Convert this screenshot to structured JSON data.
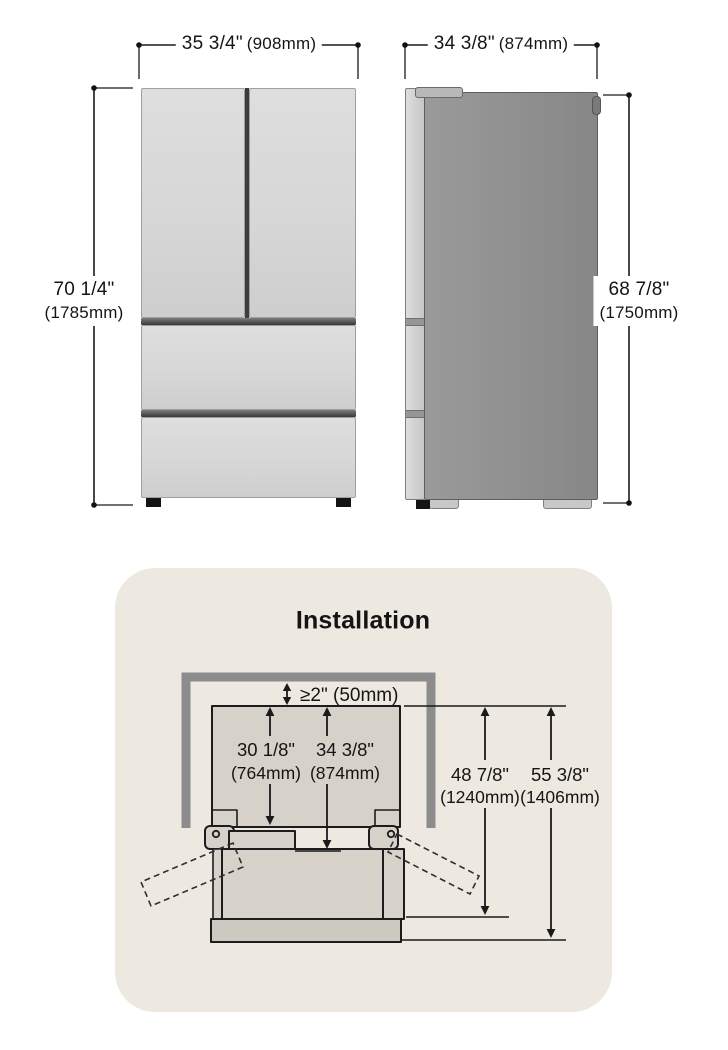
{
  "front_view": {
    "name": "refrigerator front view",
    "width": {
      "inches": "35 3/4\"",
      "mm": "(908mm)"
    },
    "height": {
      "inches": "70 1/4\"",
      "mm": "(1785mm)"
    }
  },
  "side_view": {
    "name": "refrigerator side view",
    "depth": {
      "inches": "34 3/8\"",
      "mm": "(874mm)"
    },
    "height": {
      "inches": "68 7/8\"",
      "mm": "(1750mm)"
    }
  },
  "installation": {
    "title": "Installation",
    "top_clearance": "≥2\" (50mm)",
    "depth_without_door": {
      "inches": "30 1/8\"",
      "mm": "(764mm)"
    },
    "depth_with_door": {
      "inches": "34 3/8\"",
      "mm": "(874mm)"
    },
    "depth_door_open": {
      "inches": "48 7/8\"",
      "mm": "(1240mm)"
    },
    "depth_fully_open": {
      "inches": "55 3/8\"",
      "mm": "(1406mm)"
    }
  },
  "colors": {
    "card_background": "#EDE9E0",
    "wall_gray": "#8C8C8C",
    "diagram_fill": "#D6D2C9",
    "drawer_front_fill": "#CCC9C0",
    "outline": "#1A1A1A",
    "fridge_front_fill": "#D7D7D7",
    "fridge_side_fill": "#8F8F8F"
  }
}
